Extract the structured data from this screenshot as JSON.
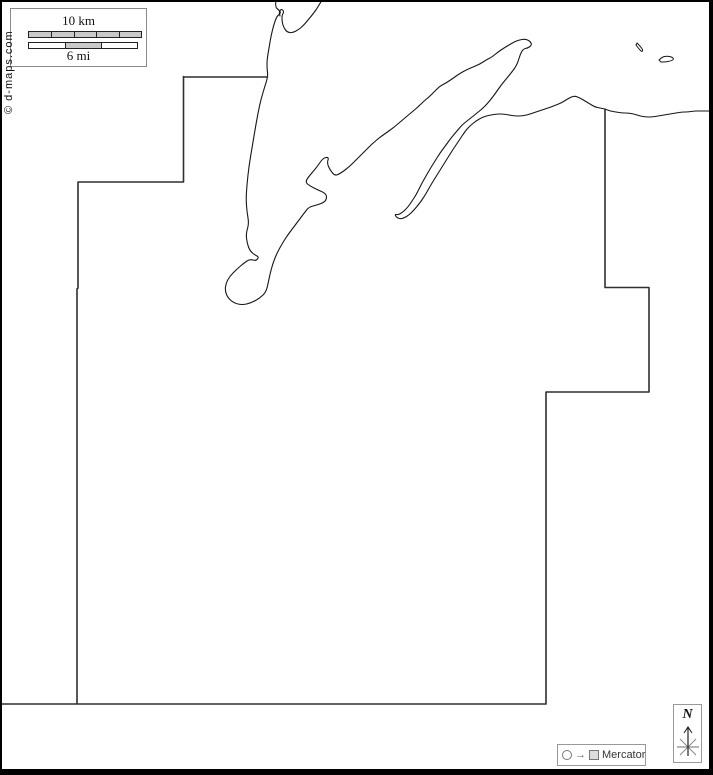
{
  "meta": {
    "credit": "© d-maps.com"
  },
  "scale_bar": {
    "km_label": "10 km",
    "mi_label": "6 mi",
    "km_segments": 5,
    "mi_segments": 3,
    "mi_shaded_segment": 2
  },
  "legend": {
    "projection_label": "Mercator",
    "arrow_glyph": "→",
    "compass_label": "N",
    "icons": [
      "circle-icon",
      "arrow-right-icon",
      "square-icon",
      "compass-star-icon"
    ]
  },
  "colors": {
    "background": "#ffffff",
    "frame": "#000000",
    "coastline": "#161616",
    "boundary": "#2f2f2f",
    "box_border": "#8a8a8a",
    "bar_fill": "#c9c9c9"
  },
  "map": {
    "shapes": [
      {
        "name": "coastline-mainland",
        "kind": "points",
        "smooth": true,
        "closed": false,
        "stroke": "coastline",
        "width": 1.1,
        "points": [
          [
            276,
            0
          ],
          [
            275,
            7
          ],
          [
            279,
            10
          ],
          [
            281,
            13
          ],
          [
            277,
            16
          ],
          [
            274,
            24
          ],
          [
            271,
            36
          ],
          [
            269,
            48
          ],
          [
            267,
            60
          ],
          [
            267,
            69
          ],
          [
            268,
            76
          ],
          [
            265,
            86
          ],
          [
            261,
            99
          ],
          [
            258,
            113
          ],
          [
            255,
            130
          ],
          [
            252,
            148
          ],
          [
            249,
            166
          ],
          [
            247,
            184
          ],
          [
            246,
            199
          ],
          [
            247,
            212
          ],
          [
            249,
            224
          ],
          [
            246,
            233
          ],
          [
            247,
            243
          ],
          [
            250,
            251
          ],
          [
            255,
            255
          ],
          [
            259,
            257
          ],
          [
            256,
            261
          ],
          [
            250,
            259
          ],
          [
            244,
            263
          ],
          [
            237,
            269
          ],
          [
            230,
            276
          ],
          [
            226,
            283
          ],
          [
            225,
            291
          ],
          [
            228,
            298
          ],
          [
            234,
            303
          ],
          [
            242,
            305
          ],
          [
            251,
            303
          ],
          [
            260,
            298
          ],
          [
            266,
            292
          ],
          [
            268,
            284
          ],
          [
            270,
            274
          ],
          [
            273,
            263
          ],
          [
            277,
            253
          ],
          [
            282,
            244
          ],
          [
            287,
            236
          ],
          [
            293,
            228
          ],
          [
            299,
            220
          ],
          [
            305,
            212
          ],
          [
            309,
            207
          ],
          [
            317,
            205
          ],
          [
            325,
            202
          ],
          [
            327,
            197
          ],
          [
            325,
            193
          ],
          [
            318,
            190
          ],
          [
            310,
            186
          ],
          [
            305,
            182
          ],
          [
            310,
            175
          ],
          [
            317,
            167
          ],
          [
            323,
            158
          ],
          [
            329,
            157
          ],
          [
            327,
            163
          ],
          [
            330,
            170
          ],
          [
            335,
            176
          ],
          [
            341,
            173
          ],
          [
            349,
            167
          ],
          [
            357,
            159
          ],
          [
            365,
            151
          ],
          [
            372,
            144
          ],
          [
            379,
            138
          ],
          [
            386,
            133
          ],
          [
            393,
            128
          ],
          [
            399,
            123
          ],
          [
            406,
            117
          ],
          [
            412,
            112
          ],
          [
            418,
            107
          ],
          [
            424,
            101
          ],
          [
            429,
            97
          ],
          [
            434,
            92
          ],
          [
            440,
            86
          ],
          [
            446,
            83
          ],
          [
            452,
            79
          ],
          [
            459,
            74
          ],
          [
            466,
            70
          ],
          [
            473,
            67
          ],
          [
            480,
            64
          ],
          [
            486,
            60
          ],
          [
            492,
            57
          ],
          [
            498,
            52
          ],
          [
            504,
            48
          ],
          [
            509,
            45
          ],
          [
            514,
            42
          ],
          [
            519,
            40
          ],
          [
            525,
            39
          ],
          [
            530,
            41
          ],
          [
            532,
            45
          ],
          [
            528,
            48
          ],
          [
            523,
            49
          ],
          [
            520,
            55
          ],
          [
            518,
            62
          ],
          [
            515,
            68
          ],
          [
            511,
            73
          ],
          [
            507,
            78
          ],
          [
            502,
            84
          ],
          [
            497,
            91
          ],
          [
            492,
            98
          ],
          [
            487,
            104
          ],
          [
            482,
            109
          ],
          [
            477,
            113
          ],
          [
            472,
            117
          ],
          [
            467,
            121
          ],
          [
            462,
            125
          ],
          [
            457,
            131
          ],
          [
            451,
            138
          ],
          [
            446,
            145
          ],
          [
            440,
            153
          ],
          [
            435,
            161
          ],
          [
            430,
            169
          ],
          [
            426,
            176
          ],
          [
            422,
            183
          ],
          [
            419,
            189
          ],
          [
            416,
            195
          ],
          [
            412,
            201
          ],
          [
            408,
            207
          ],
          [
            403,
            212
          ],
          [
            398,
            215
          ],
          [
            395,
            214
          ],
          [
            396,
            217
          ],
          [
            400,
            219
          ],
          [
            404,
            218
          ],
          [
            409,
            215
          ],
          [
            414,
            210
          ],
          [
            419,
            204
          ],
          [
            424,
            197
          ],
          [
            428,
            190
          ],
          [
            432,
            183
          ],
          [
            437,
            175
          ],
          [
            442,
            167
          ],
          [
            447,
            159
          ],
          [
            452,
            151
          ],
          [
            456,
            145
          ],
          [
            460,
            139
          ],
          [
            464,
            133
          ],
          [
            467,
            129
          ],
          [
            471,
            125
          ],
          [
            476,
            121
          ],
          [
            481,
            118
          ],
          [
            486,
            116
          ],
          [
            491,
            115
          ],
          [
            497,
            114
          ],
          [
            503,
            114
          ],
          [
            509,
            115
          ],
          [
            515,
            116
          ],
          [
            521,
            116
          ],
          [
            527,
            115
          ],
          [
            533,
            113
          ],
          [
            539,
            111
          ],
          [
            545,
            109
          ],
          [
            551,
            107
          ],
          [
            556,
            105
          ],
          [
            561,
            103
          ],
          [
            566,
            100
          ],
          [
            571,
            97
          ],
          [
            575,
            96
          ],
          [
            580,
            98
          ],
          [
            585,
            101
          ],
          [
            590,
            104
          ],
          [
            595,
            107
          ],
          [
            600,
            108
          ],
          [
            605,
            109
          ],
          [
            610,
            111
          ],
          [
            616,
            112
          ],
          [
            622,
            113
          ],
          [
            628,
            113
          ],
          [
            634,
            114
          ],
          [
            640,
            116
          ],
          [
            646,
            117
          ],
          [
            652,
            117
          ],
          [
            658,
            116
          ],
          [
            664,
            115
          ],
          [
            670,
            114
          ],
          [
            676,
            113
          ],
          [
            682,
            112
          ],
          [
            688,
            112
          ],
          [
            694,
            111
          ],
          [
            701,
            111
          ],
          [
            708,
            111
          ],
          [
            714,
            111
          ]
        ]
      },
      {
        "name": "coastline-spit",
        "kind": "points",
        "smooth": true,
        "closed": false,
        "stroke": "coastline",
        "width": 1.1,
        "points": [
          [
            322,
            0
          ],
          [
            318,
            7
          ],
          [
            313,
            14
          ],
          [
            308,
            20
          ],
          [
            303,
            26
          ],
          [
            298,
            30
          ],
          [
            292,
            33
          ],
          [
            287,
            32
          ],
          [
            284,
            28
          ],
          [
            282,
            22
          ],
          [
            282,
            15
          ],
          [
            284,
            12
          ],
          [
            282,
            9
          ],
          [
            279,
            11
          ],
          [
            280,
            16
          ]
        ]
      },
      {
        "name": "islet-small",
        "kind": "points",
        "smooth": true,
        "closed": true,
        "stroke": "coastline",
        "width": 1,
        "points": [
          [
            637,
            43
          ],
          [
            640,
            46
          ],
          [
            643,
            50
          ],
          [
            642,
            52
          ],
          [
            639,
            49
          ],
          [
            636,
            45
          ]
        ]
      },
      {
        "name": "islet-oval",
        "kind": "points",
        "smooth": true,
        "closed": true,
        "stroke": "coastline",
        "width": 1,
        "points": [
          [
            659,
            60
          ],
          [
            662,
            57
          ],
          [
            667,
            56
          ],
          [
            672,
            57
          ],
          [
            674,
            59
          ],
          [
            671,
            61
          ],
          [
            665,
            62
          ],
          [
            661,
            62
          ]
        ]
      },
      {
        "name": "county-boundary-north",
        "kind": "d",
        "stroke": "boundary",
        "width": 1.6,
        "d": "M183.5,77 H267.5"
      },
      {
        "name": "county-boundary-west",
        "kind": "d",
        "stroke": "boundary",
        "width": 1.6,
        "d": "M183.5,76.5 V182 H78 V288 L77,289 V703.5"
      },
      {
        "name": "county-boundary-south-east",
        "kind": "d",
        "stroke": "boundary",
        "width": 1.6,
        "d": "M0,704 H546 V392 H649 V287.5 H605 V109"
      }
    ]
  }
}
